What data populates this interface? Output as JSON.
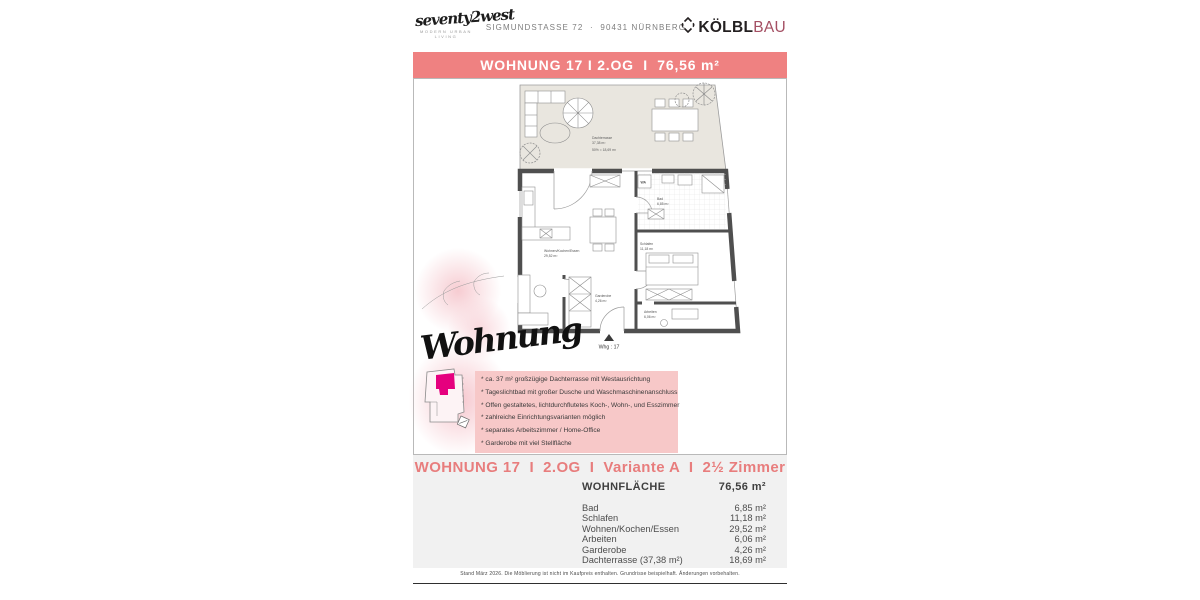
{
  "header": {
    "brand_script": "seventy2west",
    "brand_tagline": "MODERN URBAN LIVING",
    "address": "SIGMUNDSTASSE 72  ·  90431 NÜRNBERG",
    "logo_text_bold": "KÖLBL",
    "logo_text_light": "BAU"
  },
  "title_bar": "WOHNUNG 17 I 2.OG  I  76,56 m²",
  "plan": {
    "script_overlay": "Wohnung",
    "terrace_name": "Dachterrasse",
    "terrace_size": "37,38 m²",
    "terrace_note": "50% = 18,69 m²",
    "wa_label": "WA",
    "bad_name": "Bad",
    "bad_size": "6,85 m²",
    "schlafen_name": "Schlafen",
    "schlafen_size": "11,18 m²",
    "wohnen_name": "Wohnen/Kochen/Essen",
    "wohnen_size": "29,52 m²",
    "garderobe_name": "Garderobe",
    "garderobe_size": "4,26 m²",
    "arbeiten_name": "Arbeiten",
    "arbeiten_size": "6,06 m²",
    "unit_marker": "Whg : 17"
  },
  "features": [
    "* ca. 37 m² großzügige Dachterrasse mit Westausrichtung",
    "* Tageslichtbad mit großer Dusche und Waschmaschinenanschluss",
    "* Offen gestaltetes, lichtdurchflutetes Koch-, Wohn-, und Esszimmer",
    "* zahlreiche Einrichtungsvarianten möglich",
    "* separates Arbeitszimmer / Home-Office",
    "* Garderobe mit viel Stellfläche"
  ],
  "details": {
    "title": "WOHNUNG 17  I  2.OG  I  Variante A  I  2½ Zimmer",
    "area_label": "WOHNFLÄCHE",
    "area_value": "76,56 m²",
    "rows": [
      {
        "label": "Bad",
        "value": "6,85 m²"
      },
      {
        "label": "Schlafen",
        "value": "11,18 m²"
      },
      {
        "label": "Wohnen/Kochen/Essen",
        "value": "29,52 m²"
      },
      {
        "label": "Arbeiten",
        "value": "6,06 m²"
      },
      {
        "label": "Garderobe",
        "value": "4,26 m²"
      },
      {
        "label": "Dachterrasse (37,38 m²)",
        "value": "18,69 m²"
      }
    ]
  },
  "footer": "Stand März 2026. Die Möblierung ist nicht im Kaufpreis enthalten. Grundrisse beispielhaft. Änderungen vorbehalten.",
  "colors": {
    "accent": "#ef8181",
    "accent_text": "#e87d7d",
    "feature_box": "#f7c8c8",
    "logo_red": "#a44f63",
    "unit_highlight": "#e5007e",
    "section_bg": "#f1f1f1"
  }
}
